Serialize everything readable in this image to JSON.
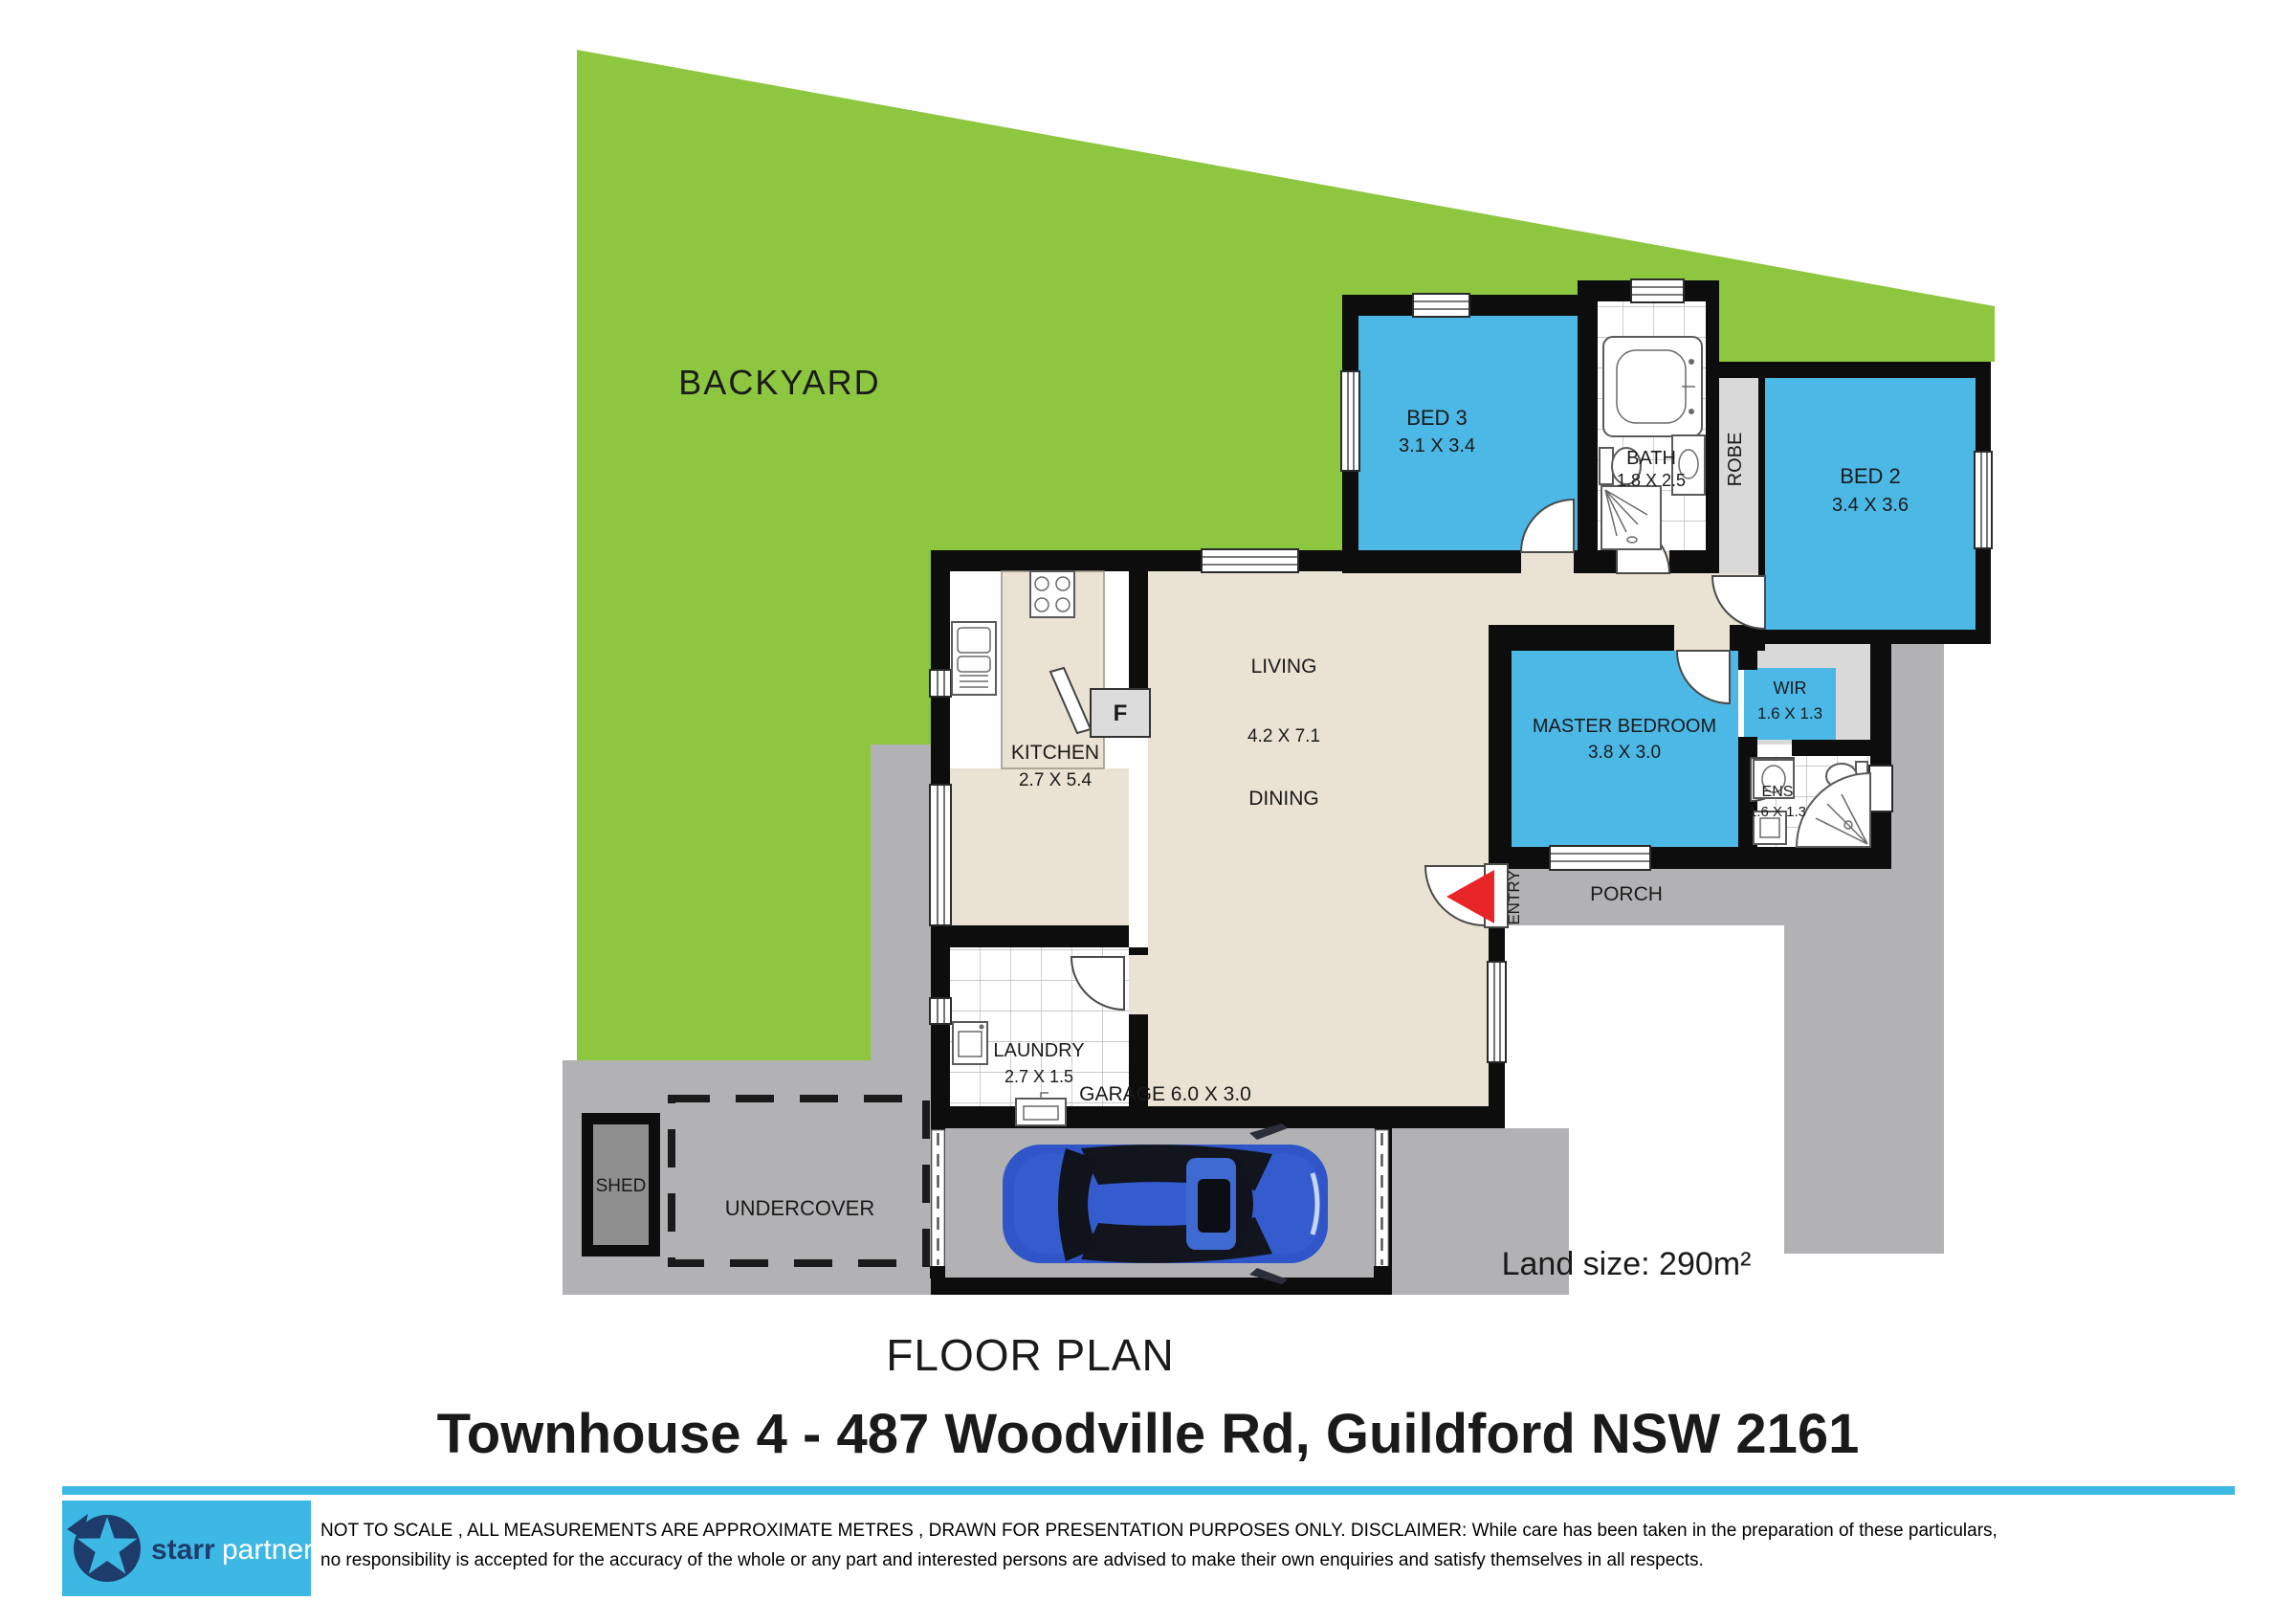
{
  "labels": {
    "backyard": "BACKYARD",
    "porch": "PORCH",
    "entry": "ENTRY",
    "robe": "ROBE",
    "fridge": "F",
    "garage": "GARAGE 6.0 X 3.0",
    "dining": "DINING",
    "undercover": "UNDERCOVER",
    "shed": "SHED"
  },
  "rooms": {
    "bed3": {
      "name": "BED 3",
      "dims": "3.1 X 3.4"
    },
    "bath": {
      "name": "BATH",
      "dims": "1.8 X 2.5"
    },
    "bed2": {
      "name": "BED 2",
      "dims": "3.4 X 3.6"
    },
    "kitchen": {
      "name": "KITCHEN",
      "dims": "2.7 X 5.4"
    },
    "living": {
      "name": "LIVING",
      "dims": "4.2 X 7.1"
    },
    "master": {
      "name": "MASTER BEDROOM",
      "dims": "3.8 X 3.0"
    },
    "wir": {
      "name": "WIR",
      "dims": "1.6 X 1.3"
    },
    "ens": {
      "name": "ENS",
      "dims": "1.6 X 1.3"
    },
    "laundry": {
      "name": "LAUNDRY",
      "dims": "2.7 X 1.5"
    }
  },
  "footer": {
    "floor_plan": "FLOOR PLAN",
    "address": "Townhouse 4 - 487 Woodville Rd, Guildford NSW 2161",
    "land_size": "Land size: 290m²",
    "logo_starr": "starr",
    "logo_partners": "partners",
    "disclaimer1": "NOT TO SCALE , ALL MEASUREMENTS ARE APPROXIMATE METRES , DRAWN FOR PRESENTATION PURPOSES ONLY. DISCLAIMER:  While care has been taken in the preparation of these particulars,",
    "disclaimer2": "no responsibility is accepted for the accuracy of  the whole or any part and interested  persons are advised to make their own enquiries and satisfy  themselves in all respects."
  },
  "colors": {
    "backyard_green": "#8dc63f",
    "room_blue": "#4cb8e6",
    "floor_beige": "#eae3d3",
    "paving_gray": "#b2b2b4",
    "closet_gray": "#d9d9d9",
    "shed_gray": "#8f8f8f",
    "wall_black": "#0d0d0d",
    "entry_red": "#e8262a",
    "logo_blue": "#3db7e4",
    "logo_navy": "#1d3c6b",
    "car_blue": "#2f55c8"
  }
}
